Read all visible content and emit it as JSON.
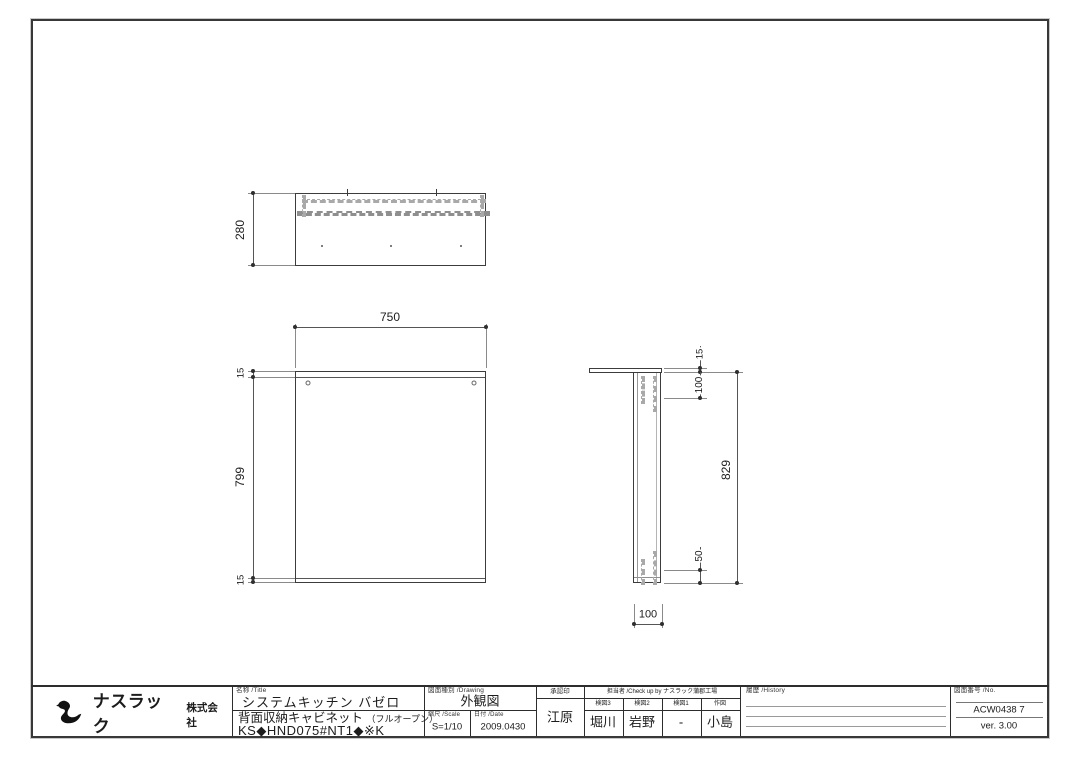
{
  "company": {
    "logo_icon": "swan-icon",
    "name_main": "ナスラック",
    "name_sub": "株式会社"
  },
  "title_block": {
    "name_label": "名称  /Title",
    "product_line1": "システムキッチン バゼロ",
    "product_line2": "背面収納キャビネット",
    "product_line2_note": "（フルオープン）",
    "model_code": "KS◆HND075#NT1◆※K",
    "drawing_type_label": "図面種別  /Drawing",
    "drawing_type": "外観図",
    "scale_label": "縮尺  /Scale",
    "scale": "S=1/10",
    "date_label": "日付  /Date",
    "date": "2009.0430",
    "approval_label": "承認印",
    "approval_name": "江原",
    "check_group_label": "担当者 /Check up by ナスラック蒲郡工場",
    "check_cols": [
      {
        "label": "検図3",
        "value": "堀川"
      },
      {
        "label": "検図2",
        "value": "岩野"
      },
      {
        "label": "検図1",
        "value": "-"
      },
      {
        "label": "作図",
        "value": "小島"
      }
    ],
    "history_label": "履歴  /History",
    "drawing_no_label": "図面番号  /No.",
    "drawing_no": "ACW0438 7",
    "version": "ver. 3.00"
  },
  "dimensions": {
    "top_view": {
      "depth": "280"
    },
    "front_view": {
      "width": "750",
      "top_panel": "15",
      "body_height": "799",
      "bottom_panel": "15"
    },
    "side_view": {
      "top_panel": "15",
      "upper_offset": "100",
      "total_height": "829",
      "lower_offset": "50",
      "depth": "100"
    }
  }
}
